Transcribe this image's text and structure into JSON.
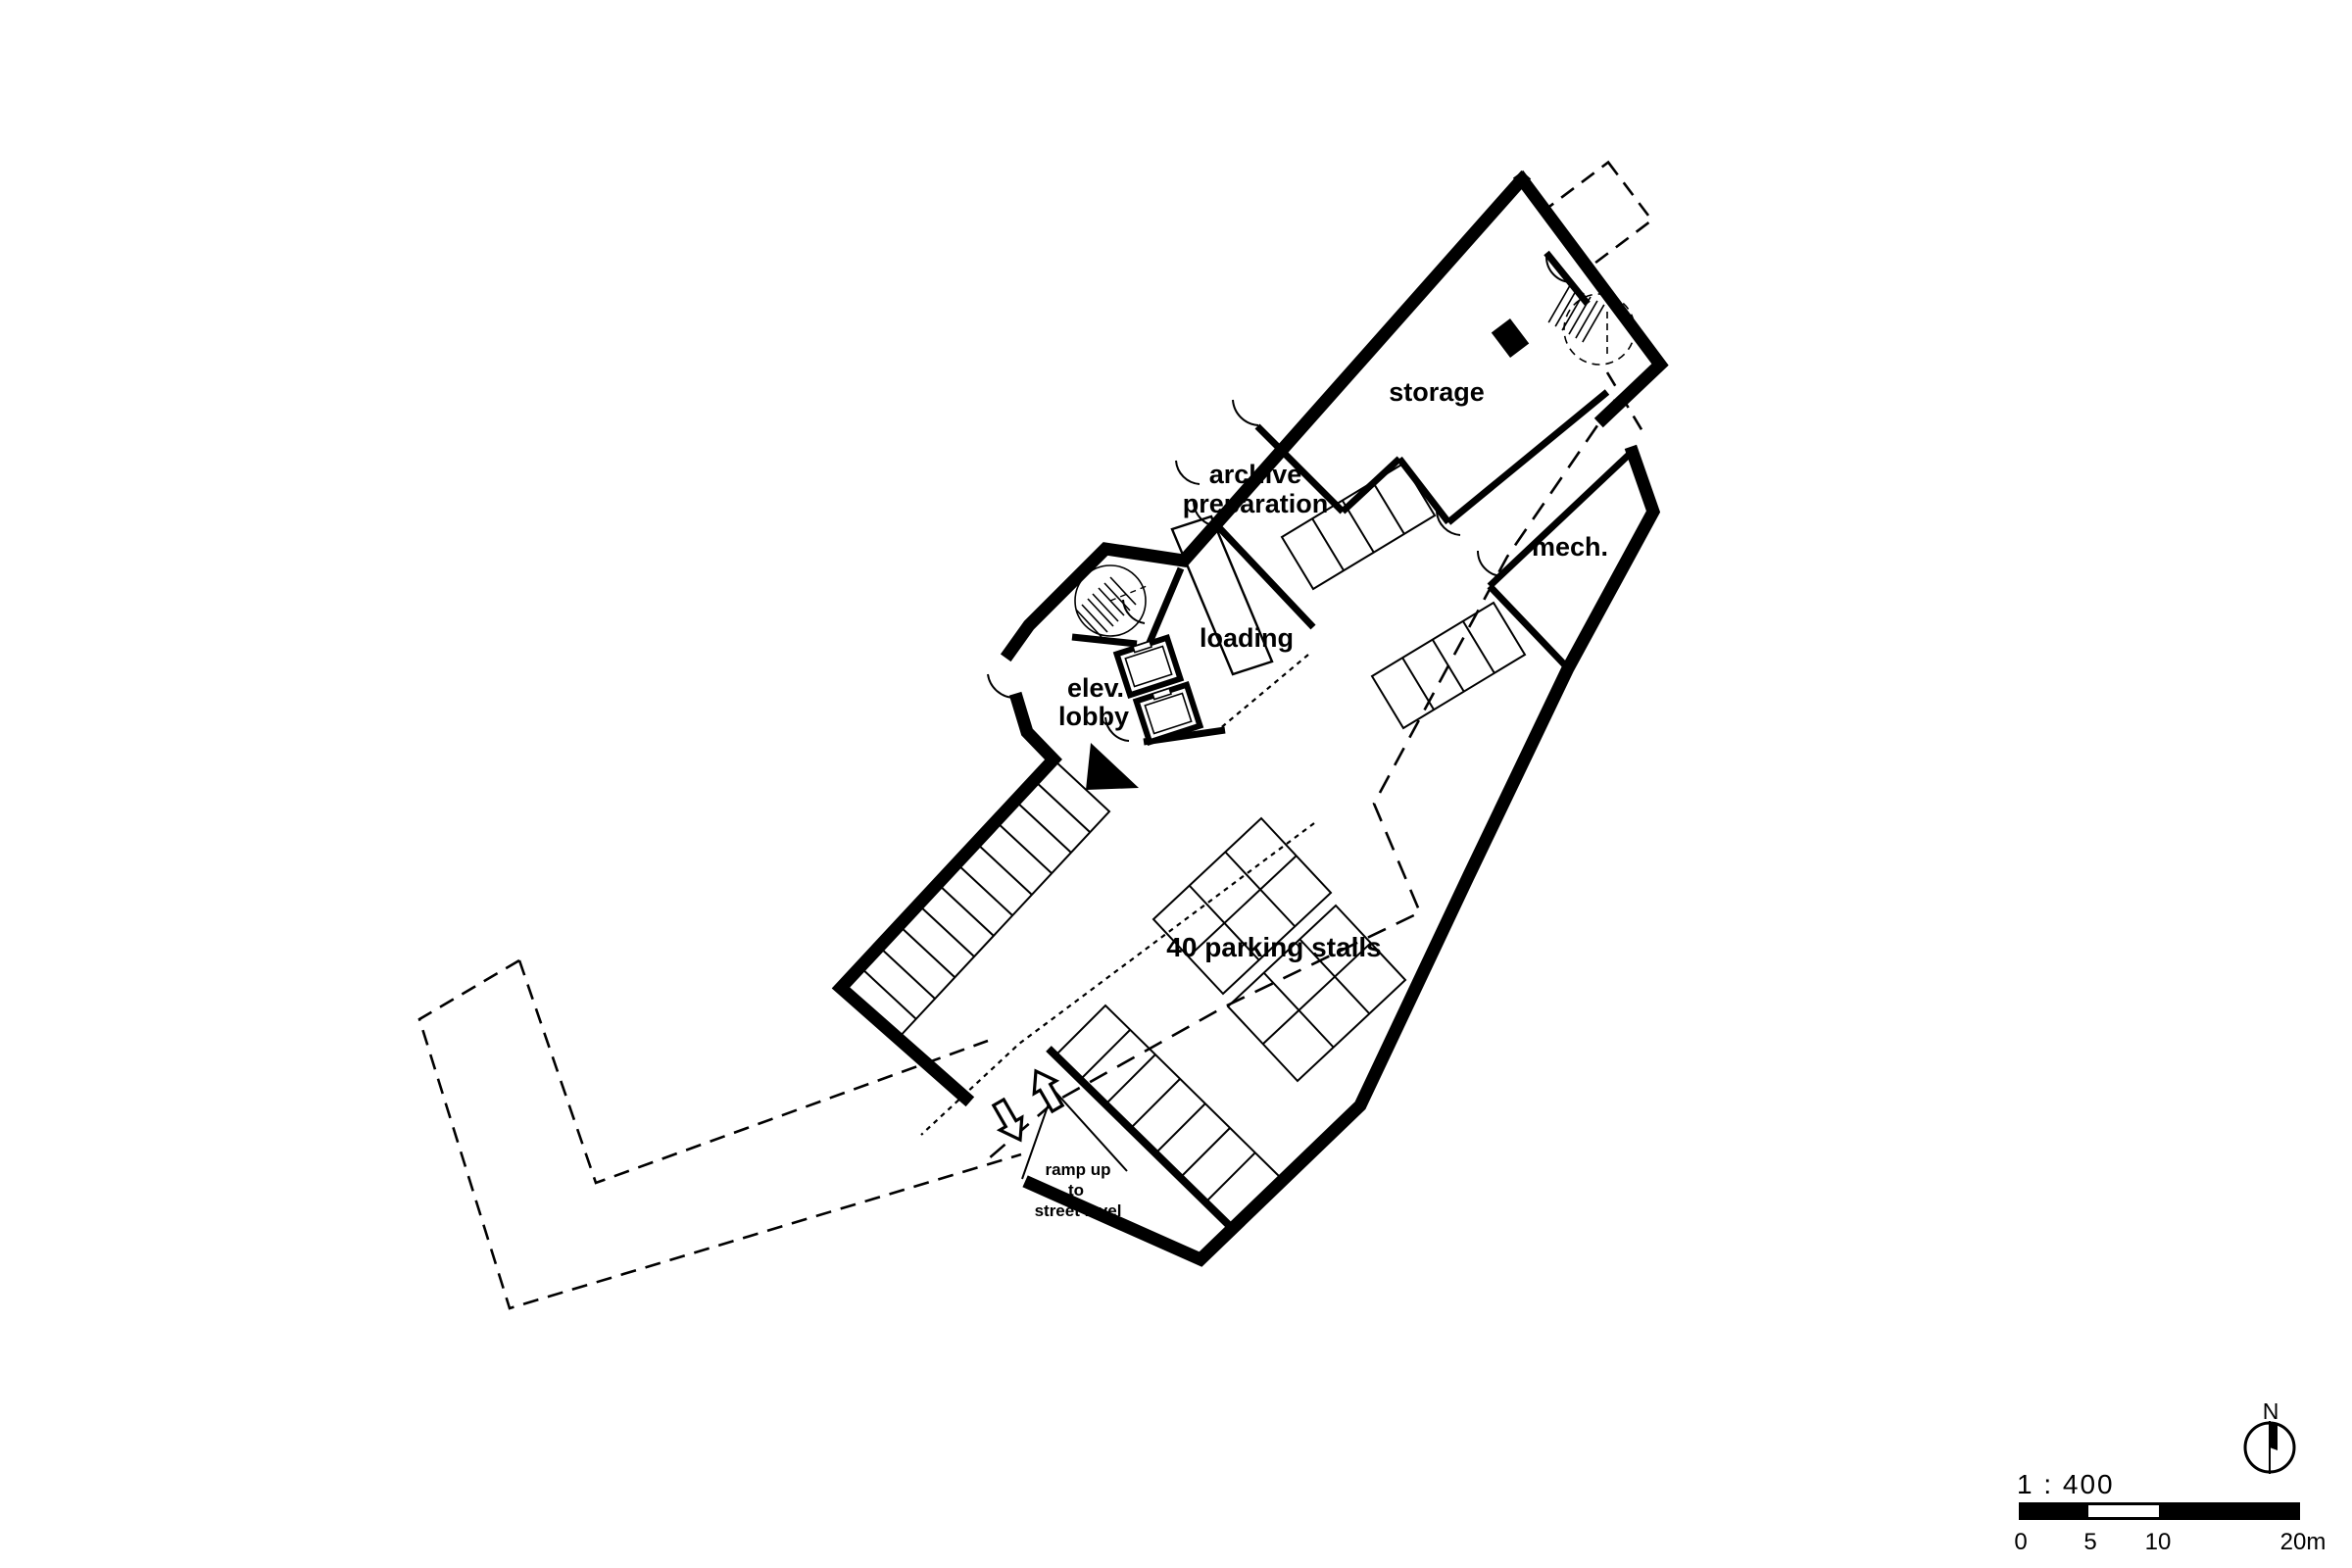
{
  "page": {
    "title": "basement floor plan",
    "colors": {
      "ink": "#000000",
      "paper": "#ffffff"
    }
  },
  "plan": {
    "room_labels": {
      "storage": "storage",
      "archive_line1": "archive",
      "archive_line2": "preparation",
      "mech": "mech.",
      "loading": "loading",
      "elev_line1": "elev.",
      "elev_line2": "lobby",
      "parking": "40 parking stalls"
    },
    "ramp_label": {
      "line1": "ramp up",
      "line2": "to",
      "line3": "street level"
    }
  },
  "legend": {
    "scale_ratio": "1 : 400",
    "scale_ticks": {
      "t0": "0",
      "t5": "5",
      "t10": "10",
      "t20": "20m"
    },
    "north_label": "N"
  }
}
